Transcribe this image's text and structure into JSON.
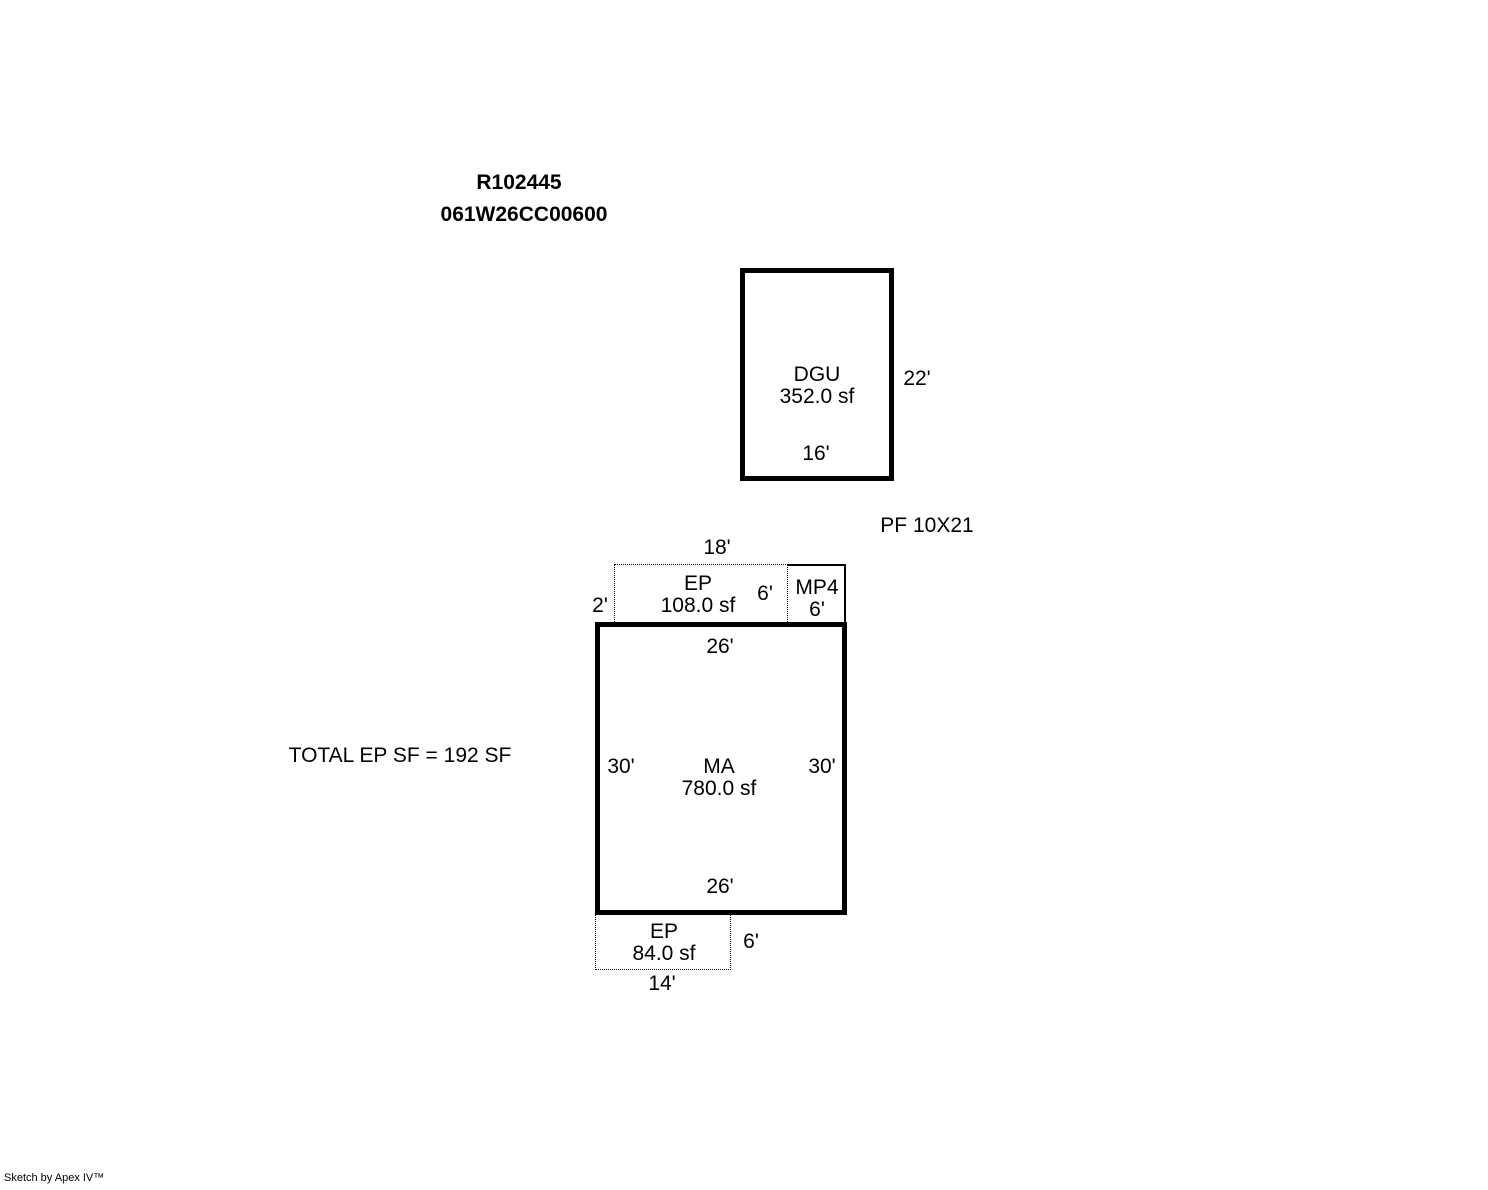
{
  "header": {
    "sketch_id": "R102445",
    "parcel_id": "061W26CC00600"
  },
  "areas": {
    "dgu": {
      "label": "DGU",
      "area": "352.0 sf",
      "dim_right": "22'",
      "dim_bottom": "16'"
    },
    "pf_note": "PF 10X21",
    "ep_top": {
      "label": "EP",
      "area": "108.0 sf",
      "dim_top": "18'",
      "dim_left": "2'",
      "dim_right": "6'"
    },
    "mp4": {
      "label": "MP4",
      "dim": "6'"
    },
    "ma": {
      "label": "MA",
      "area": "780.0 sf",
      "dim_top": "26'",
      "dim_left": "30'",
      "dim_right": "30'",
      "dim_bottom": "26'"
    },
    "ep_bottom": {
      "label": "EP",
      "area": "84.0 sf",
      "dim_right": "6'",
      "dim_bottom": "14'"
    },
    "total_note": "TOTAL EP SF = 192 SF"
  },
  "footer": {
    "credit": "Sketch by Apex IV™"
  },
  "colors": {
    "background": "#ffffff",
    "line": "#000000"
  }
}
